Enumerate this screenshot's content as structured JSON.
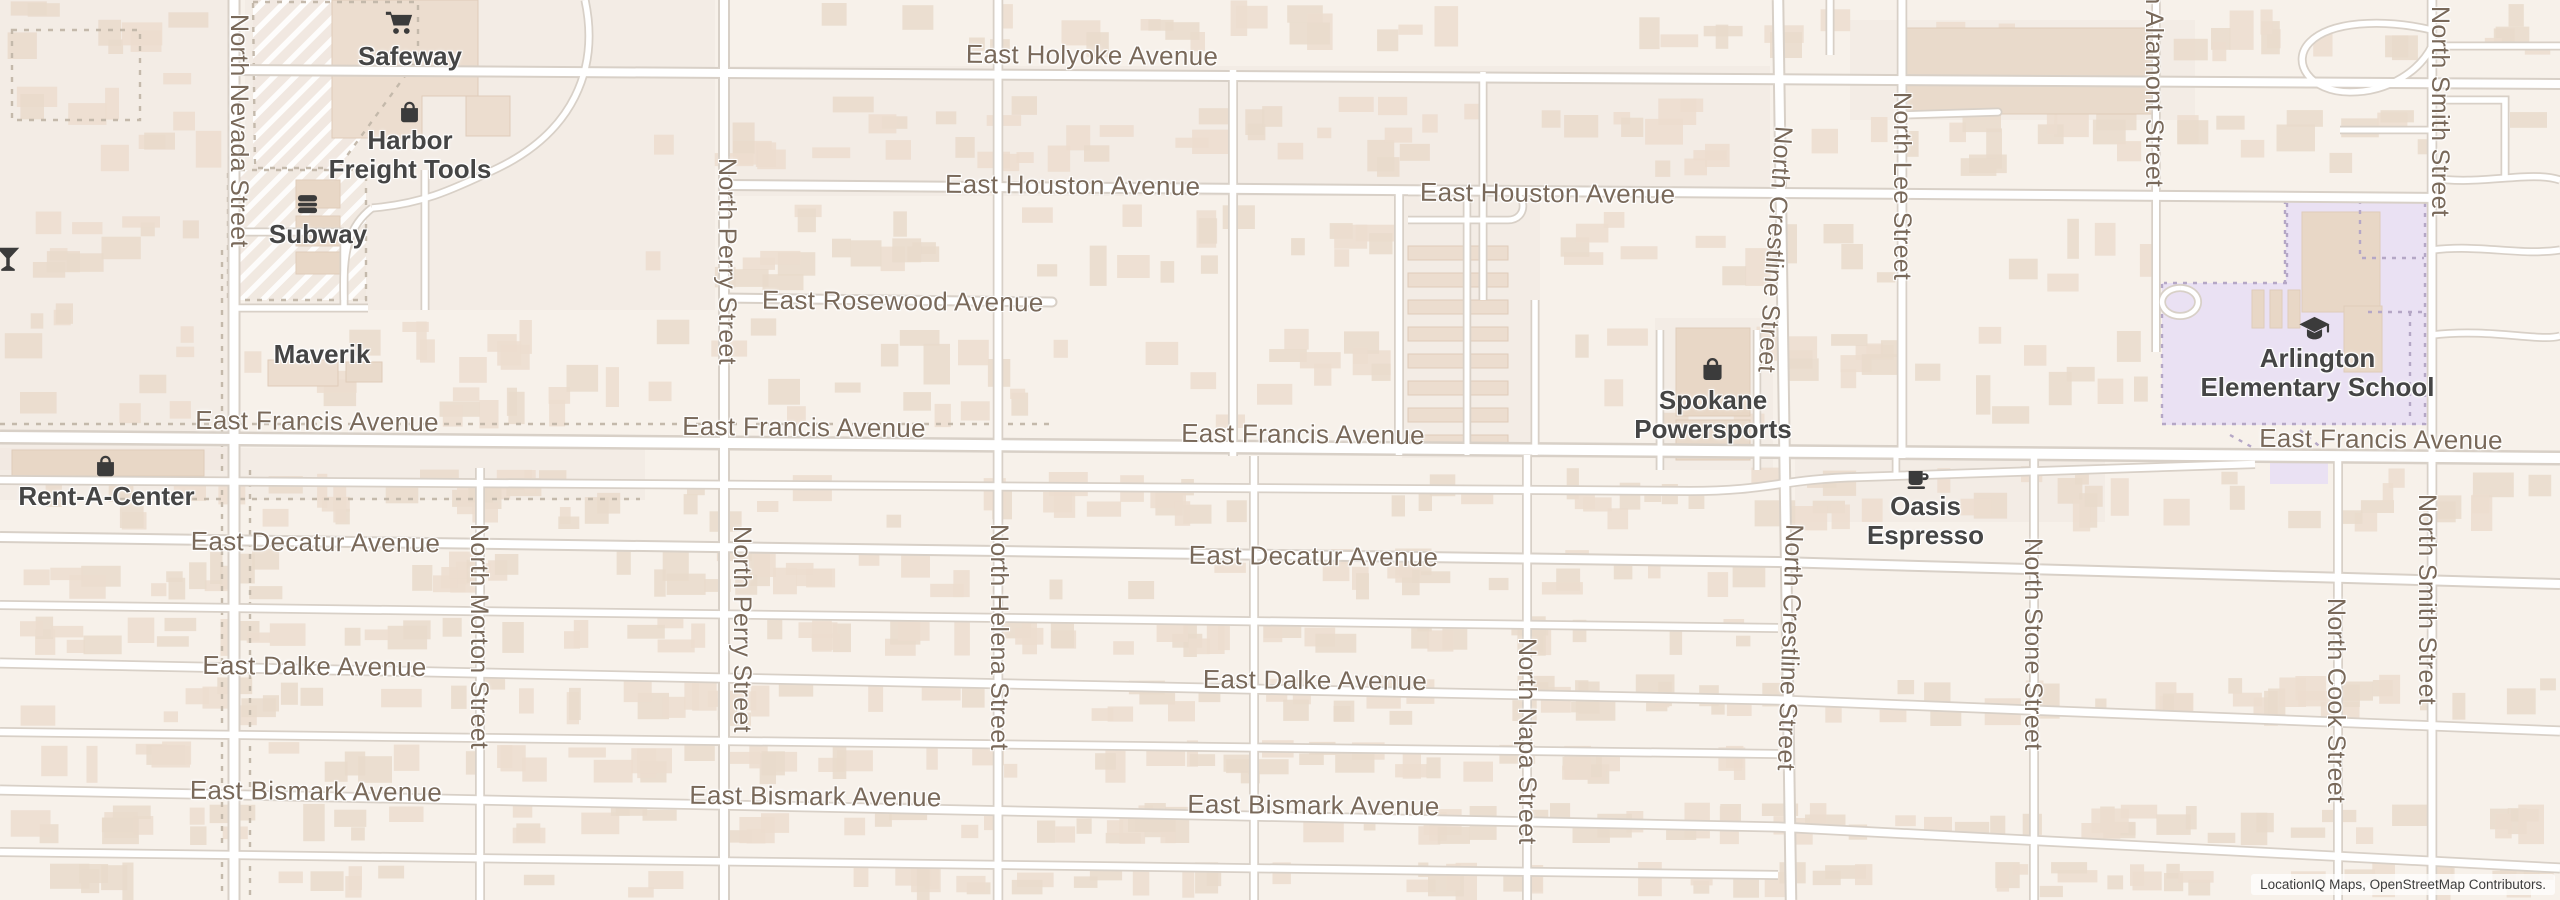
{
  "map": {
    "attribution": "LocationIQ Maps, OpenStreetMap Contributors.",
    "colors": {
      "land": "#f7f1ea",
      "lot": "#f1e8e0",
      "road_fill": "#ffffff",
      "road_casing": "#d8d0c7",
      "building": "#ecddcf",
      "building_alt": "#e9dacb",
      "building_line": "#dfccba",
      "big_building": "#e8d7c6",
      "school_area": "#eae1f3",
      "school_fence": "#b5a7c6",
      "street_text": "#79695a",
      "poi_text": "#454545",
      "icon": "#3b3b3b",
      "dashed_line": "#c4b9ab"
    }
  },
  "streets": {
    "holyoke": "East Holyoke Avenue",
    "houston": "East Houston Avenue",
    "rosewood": "East Rosewood Avenue",
    "francis": "East Francis Avenue",
    "decatur": "East Decatur Avenue",
    "dalke": "East Dalke Avenue",
    "bismark": "East Bismark Avenue",
    "nevada": "North Nevada Street",
    "morton": "North Morton Street",
    "perry": "North Perry Street",
    "helena": "North Helena Street",
    "napa": "North Napa Street",
    "crestline": "North Crestline Street",
    "lee": "North Lee Street",
    "stone": "North Stone Street",
    "altamont": "North Altamont Street",
    "cook": "North Cook Street",
    "smith": "North Smith Street"
  },
  "pois": {
    "safeway": {
      "label": "Safeway",
      "icon": "shopping-cart"
    },
    "harbor_freight": {
      "label": "Harbor Freight Tools",
      "icon": "shopping-bag"
    },
    "subway": {
      "label": "Subway",
      "icon": "burger"
    },
    "maverik": {
      "label": "Maverik"
    },
    "rent_a_center": {
      "label": "Rent-A-Center",
      "icon": "shopping-bag"
    },
    "spokane_powersports": {
      "label": "Spokane Powersports",
      "icon": "shopping-bag"
    },
    "oasis_espresso": {
      "label": "Oasis Espresso",
      "icon": "coffee-cup"
    },
    "arlington_elementary": {
      "label": "Arlington Elementary School",
      "icon": "graduation-cap"
    },
    "edge_bar": {
      "label": "",
      "icon": "cocktail"
    }
  }
}
